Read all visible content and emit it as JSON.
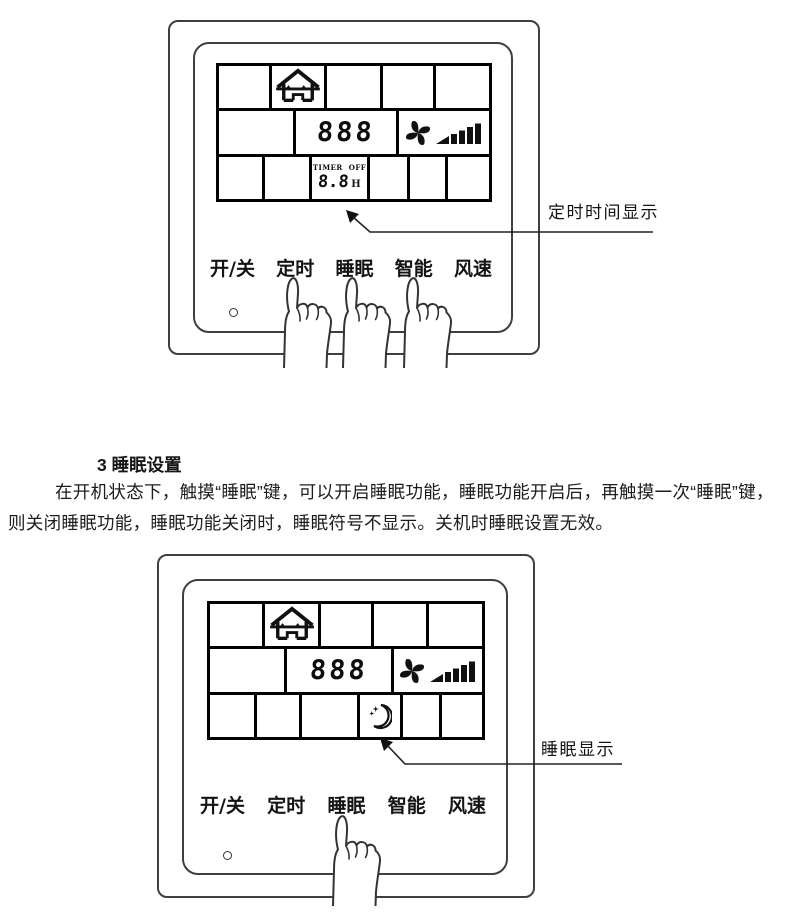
{
  "section": {
    "heading": "3 睡眠设置",
    "body": "在开机状态下，触摸“睡眠”键，可以开启睡眠功能，睡眠功能开启后，再触摸一次“睡眠”键，则关闭睡眠功能，睡眠功能关闭时，睡眠符号不显示。关机时睡眠设置无效。"
  },
  "figure_top": {
    "annotation_label": "定时时间显示",
    "lcd": {
      "temperature": "888",
      "timer_title": "TIMER",
      "timer_state": "OFF",
      "timer_value": "8.8",
      "timer_unit": "H"
    },
    "buttons": [
      {
        "label": "开/关"
      },
      {
        "label": "定时"
      },
      {
        "label": "睡眠"
      },
      {
        "label": "智能"
      },
      {
        "label": "风速"
      }
    ],
    "hands_pointing_at": [
      "定时",
      "睡眠",
      "智能"
    ]
  },
  "figure_bottom": {
    "annotation_label": "睡眠显示",
    "lcd": {
      "temperature": "888"
    },
    "buttons": [
      {
        "label": "开/关"
      },
      {
        "label": "定时"
      },
      {
        "label": "睡眠"
      },
      {
        "label": "智能"
      },
      {
        "label": "风速"
      }
    ],
    "hands_pointing_at": [
      "睡眠"
    ]
  },
  "icons": {
    "house": "fresh-air-house-icon",
    "fan": "fan-speed-icon",
    "sleep": "sleep-moon-icon",
    "timer": "timer-display",
    "hand": "pointing-hand-icon",
    "arrow": "callout-arrow-icon",
    "indicator": "power-indicator-dot"
  },
  "colors": {
    "ink": "#1a1a1a",
    "panel_line": "#3f3f3f",
    "lcd_grid": "#000000",
    "background": "#ffffff"
  }
}
